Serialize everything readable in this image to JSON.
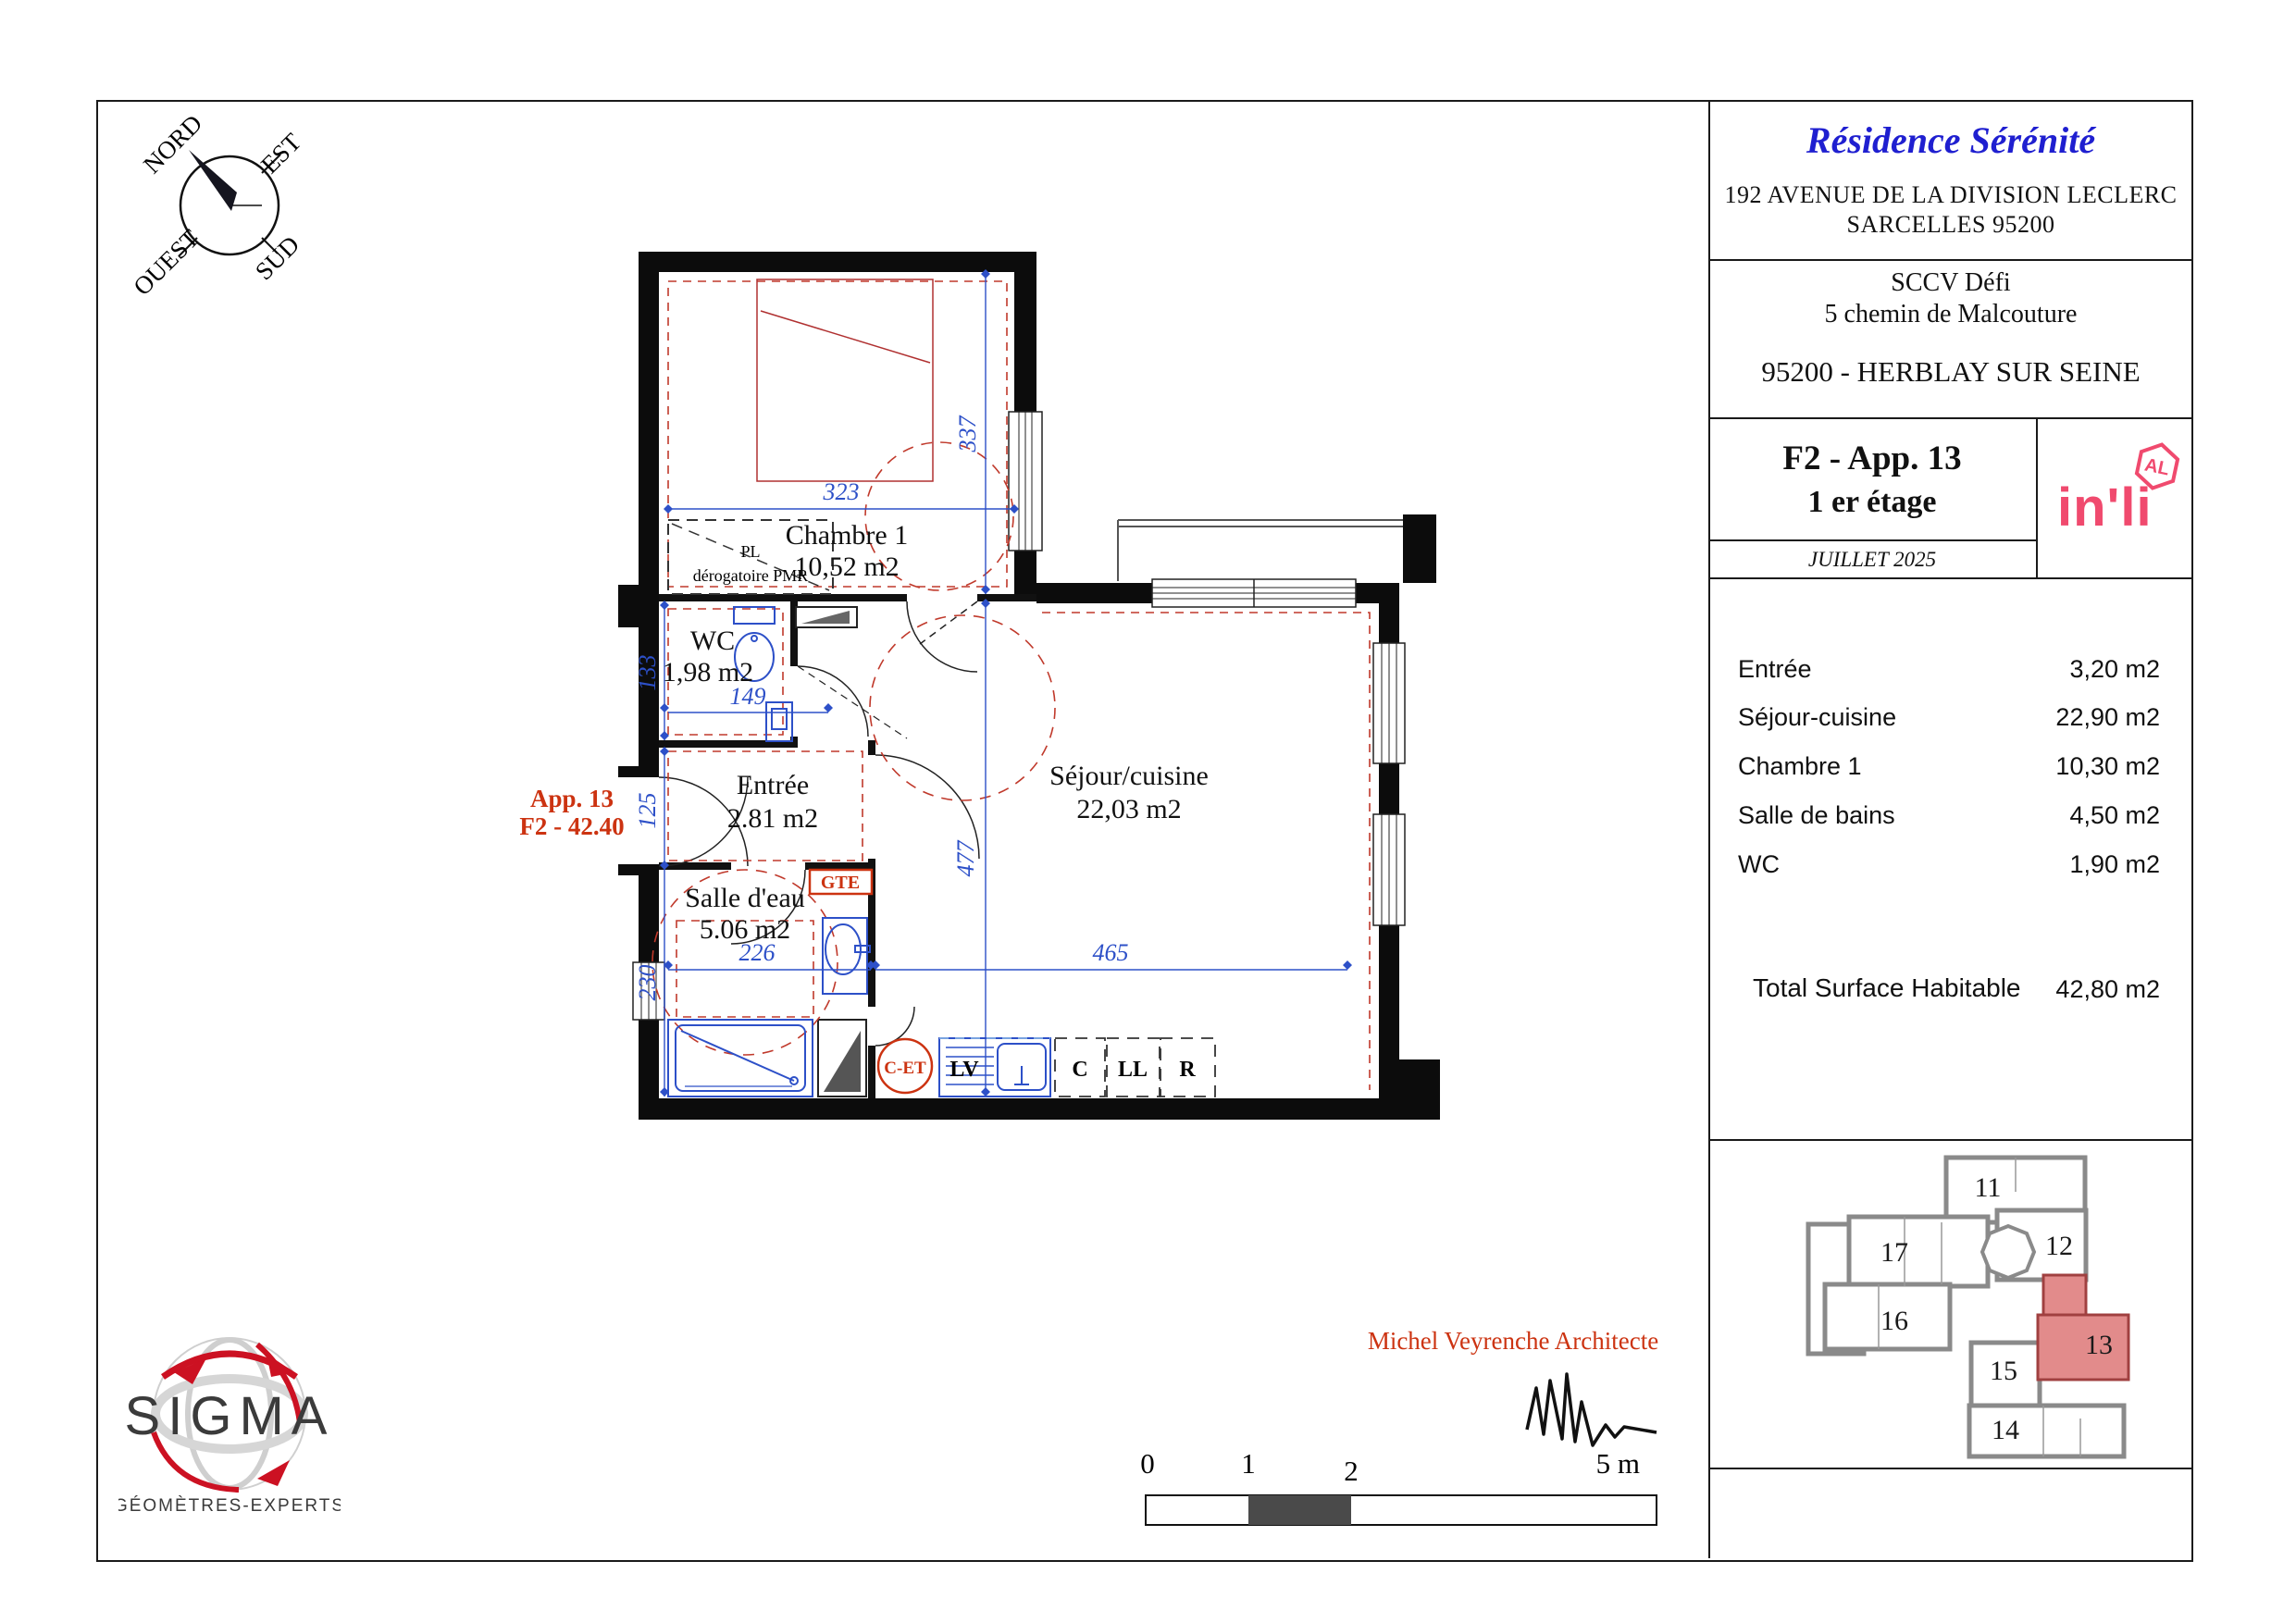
{
  "title_block": {
    "residence": "Résidence Sérénité",
    "address_line1": "192 AVENUE DE LA DIVISION LECLERC",
    "address_line2": "SARCELLES 95200",
    "developer_line1": "SCCV Défi",
    "developer_line2": "5 chemin de Malcouture",
    "city_line": "95200 - HERBLAY SUR SEINE",
    "apartment": "F2 - App. 13",
    "floor": "1 er étage",
    "date": "JUILLET 2025",
    "brand": "in'li",
    "brand_badge": "AL"
  },
  "areas": {
    "rows": [
      {
        "label": "Entrée",
        "value": "3,20 m2"
      },
      {
        "label": "Séjour-cuisine",
        "value": "22,90 m2"
      },
      {
        "label": "Chambre 1",
        "value": "10,30 m2"
      },
      {
        "label": "Salle de bains",
        "value": "4,50 m2"
      },
      {
        "label": "WC",
        "value": "1,90 m2"
      }
    ],
    "total_label": "Total Surface Habitable",
    "total_value": "42,80 m2"
  },
  "plan": {
    "apartment_ref_line1": "App. 13",
    "apartment_ref_line2": "F2 - 42.40",
    "rooms": [
      {
        "name": "Chambre 1",
        "area": "10,52 m2"
      },
      {
        "name": "WC",
        "area": "1,98 m2"
      },
      {
        "name": "Entrée",
        "area": "2.81 m2"
      },
      {
        "name": "Salle d'eau",
        "area": "5.06 m2"
      },
      {
        "name": "Séjour/cuisine",
        "area": "22,03 m2"
      }
    ],
    "closet_line1": "PL",
    "closet_line2": "dérogatoire PMR",
    "labels": {
      "gte": "GTE",
      "cet": "C-ET",
      "lv": "LV",
      "c": "C",
      "ll": "LL",
      "r": "R"
    },
    "dims": {
      "chambre_w": "323",
      "chambre_h": "337",
      "wc_h": "133",
      "wc_w": "149",
      "entree_h": "125",
      "sejour_h": "477",
      "salle_w": "226",
      "salle_h": "230",
      "sejour_w": "465"
    }
  },
  "compass": {
    "n": "NORD",
    "e": "EST",
    "s": "SUD",
    "w": "OUEST"
  },
  "key_plan": {
    "units": [
      "11",
      "12",
      "13",
      "14",
      "15",
      "16",
      "17"
    ],
    "highlighted_unit": "13"
  },
  "architect": {
    "name": "Michel Veyrenche Architecte"
  },
  "surveyor": {
    "name": "SIGMA",
    "subtitle": "GÉOMÈTRES-EXPERTS"
  },
  "scale_bar": {
    "t0": "0",
    "t1": "1",
    "t2": "2",
    "t5": "5 m"
  },
  "colors": {
    "dimension_blue": "#2d50c8",
    "annotation_red": "#cc3311",
    "brand_pink": "#f04a6e",
    "residence_blue": "#1f1fd0",
    "highlight_salmon": "#e28b8b"
  }
}
